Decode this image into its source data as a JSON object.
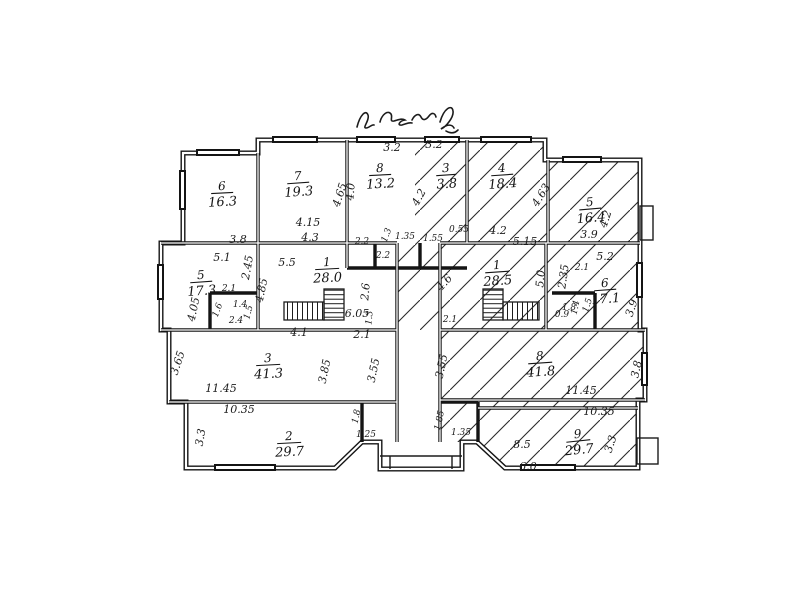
{
  "document": {
    "kind": "scanned hand-drawn architectural floor plan",
    "handwritten_annotation": "illegible cursive inscription",
    "ink_color": "#1c1c1c",
    "paper_color": "#ffffff"
  },
  "rooms": [
    {
      "n": "6",
      "a": "16.3",
      "unit": "left"
    },
    {
      "n": "7",
      "a": "19.3",
      "unit": "left"
    },
    {
      "n": "8",
      "a": "13.2",
      "unit": "left"
    },
    {
      "n": "3",
      "a": "3.8",
      "unit": "right"
    },
    {
      "n": "4",
      "a": "18.4",
      "unit": "right"
    },
    {
      "n": "5",
      "a": "16.4",
      "unit": "right"
    },
    {
      "n": "5",
      "a": "17.3",
      "unit": "left"
    },
    {
      "n": "1",
      "a": "28.0",
      "unit": "left"
    },
    {
      "n": "1",
      "a": "28.5",
      "unit": "right"
    },
    {
      "n": "6",
      "a": "17.1",
      "unit": "right"
    },
    {
      "n": "3",
      "a": "41.3",
      "unit": "left"
    },
    {
      "n": "8",
      "a": "41.8",
      "unit": "right"
    },
    {
      "n": "2",
      "a": "29.7",
      "unit": "left"
    },
    {
      "n": "9",
      "a": "29.7",
      "unit": "right"
    }
  ],
  "dims": [
    "3.8",
    "5.1",
    "4.05",
    "2.45",
    "4.85",
    "2.1",
    "1.4",
    "1.5",
    "2.4",
    "1.6",
    "5.5",
    "4.15",
    "4.3",
    "4.65",
    "4.0",
    "3.2",
    "2.2",
    "1.3",
    "2.2",
    "2.6",
    "6.05",
    "1.3",
    "4.1",
    "2.1",
    "3.65",
    "3.85",
    "3.55",
    "11.45",
    "10.35",
    "3.3",
    "1.8",
    "1.25",
    "1.35",
    "1.55",
    "0.55",
    "4.6",
    "2.1",
    "3.2",
    "4.2",
    "4.2",
    "5.15",
    "4.63",
    "3.9",
    "4.2",
    "5.2",
    "2.35",
    "5.0",
    "2.1",
    "1.4",
    "1.5",
    "1.8",
    "0.9",
    "3.9",
    "3.55",
    "11.45",
    "3.8",
    "10.35",
    "1.85",
    "1.35",
    "8.5",
    "6.0",
    "3.3"
  ]
}
